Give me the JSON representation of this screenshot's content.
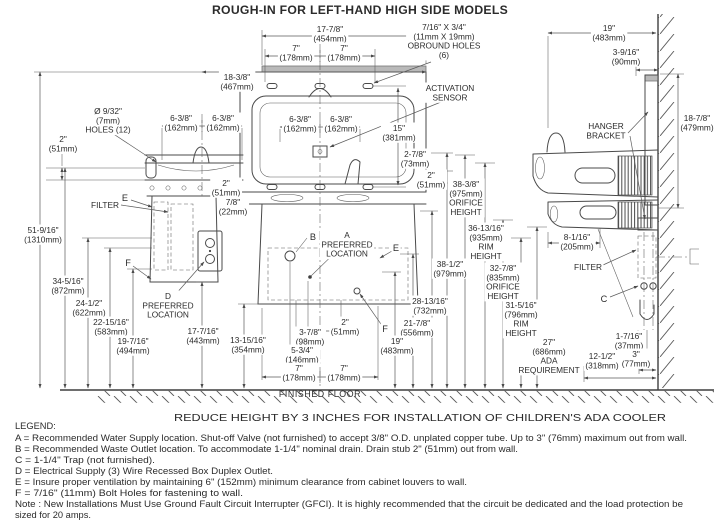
{
  "title": "ROUGH-IN FOR LEFT-HAND HIGH SIDE MODELS",
  "reduce_note": "REDUCE HEIGHT BY 3 INCHES FOR INSTALLATION OF CHILDREN'S ADA COOLER",
  "finished_floor": "FINISHED FLOOR",
  "legend": {
    "heading": "LEGEND:",
    "items": [
      "A = Recommended Water Supply location. Shut-off Valve (not furnished) to accept 3/8\" O.D. unplated copper tube. Up to 3\" (76mm) maximum out from wall.",
      "B = Recommended Waste Outlet location. To accommodate 1-1/4\" nominal drain. Drain stub 2\" (51mm) out from wall.",
      "C = 1-1/4\" Trap (not furnished).",
      "D = Electrical Supply (3) Wire Recessed Box Duplex Outlet.",
      "E = Insure proper ventilation by maintaining 6\" (152mm) minimum clearance from cabinet louvers to wall.",
      "F = 7/16\" (11mm) Bolt Holes for fastening to wall.",
      "Note : New Installations Must Use Ground Fault Circuit Interrupter (GFCI). It is highly recommended that the circuit be dedicated and the load protection be",
      "sized for 20 amps."
    ]
  },
  "dims": {
    "w454": [
      "17-7/8\"",
      "(454mm)"
    ],
    "w178l": [
      "7\"",
      "(178mm)"
    ],
    "w178r": [
      "7\"",
      "(178mm)"
    ],
    "obround": [
      "7/16\" X 3/4\"",
      "(11mm X 19mm)",
      "OBROUND HOLES",
      "(6)"
    ],
    "w467": [
      "18-3/8\"",
      "(467mm)"
    ],
    "sensor": [
      "ACTIVATION",
      "SENSOR"
    ],
    "holes12": [
      "Ø 9/32\"",
      "(7mm)",
      "HOLES (12)"
    ],
    "h51l": [
      "2\"",
      "(51mm)"
    ],
    "s638a": [
      "6-3/8\"",
      "(162mm)"
    ],
    "s638b": [
      "6-3/8\"",
      "(162mm)"
    ],
    "s638c": [
      "6-3/8\"",
      "(162mm)"
    ],
    "s638d": [
      "6-3/8\"",
      "(162mm)"
    ],
    "v381": [
      "15\"",
      "(381mm)"
    ],
    "h73": [
      "2-7/8\"",
      "(73mm)"
    ],
    "h51r": [
      "2\"",
      "(51mm)"
    ],
    "orifice1": [
      "38-3/8\"",
      "(975mm)",
      "ORIFICE",
      "HEIGHT"
    ],
    "rim1": [
      "36-13/16\"",
      "(935mm)",
      "RIM",
      "HEIGHT"
    ],
    "v979": [
      "38-1/2\"",
      "(979mm)"
    ],
    "orifice2": [
      "32-7/8\"",
      "(835mm)",
      "ORIFICE",
      "HEIGHT"
    ],
    "rim2": [
      "31-5/16\"",
      "(796mm)",
      "RIM",
      "HEIGHT"
    ],
    "ada": [
      "27\"",
      "(686mm)",
      "ADA",
      "REQUIREMENT"
    ],
    "v732": [
      "28-13/16\"",
      "(732mm)"
    ],
    "v556": [
      "21-7/8\"",
      "(556mm)"
    ],
    "v483": [
      "19\"",
      "(483mm)"
    ],
    "h51c": [
      "2\"",
      "(51mm)"
    ],
    "h98": [
      "3-7/8\"",
      "(98mm)"
    ],
    "h146": [
      "5-3/4\"",
      "(146mm)"
    ],
    "w178c": [
      "7\"",
      "(178mm)"
    ],
    "w178d": [
      "7\"",
      "(178mm)"
    ],
    "v354": [
      "13-15/16\"",
      "(354mm)"
    ],
    "v1310": [
      "51-9/16\"",
      "(1310mm)"
    ],
    "v872": [
      "34-5/16\"",
      "(872mm)"
    ],
    "v622": [
      "24-1/2\"",
      "(622mm)"
    ],
    "v583": [
      "22-15/16\"",
      "(583mm)"
    ],
    "v494": [
      "19-7/16\"",
      "(494mm)"
    ],
    "v443": [
      "17-7/16\"",
      "(443mm)"
    ],
    "h51d": [
      "2\"",
      "(51mm)"
    ],
    "h22": [
      "7/8\"",
      "(22mm)"
    ],
    "d_loc": [
      "D",
      "PREFERRED",
      "LOCATION"
    ],
    "a_loc": [
      "A",
      "PREFERRED",
      "LOCATION"
    ],
    "side19": [
      "19\"",
      "(483mm)"
    ],
    "side90": [
      "3-9/16\"",
      "(90mm)"
    ],
    "hanger": [
      "HANGER",
      "BRACKET"
    ],
    "side479": [
      "18-7/8\"",
      "(479mm)"
    ],
    "side205": [
      "8-1/16\"",
      "(205mm)"
    ],
    "side37": [
      "1-7/16\"",
      "(37mm)"
    ],
    "side318": [
      "12-1/2\"",
      "(318mm)"
    ],
    "side77": [
      "3\"",
      "(77mm)"
    ]
  },
  "callouts": {
    "filter_l": "FILTER",
    "filter_r": "FILTER",
    "a": "A",
    "b": "B",
    "c": "C",
    "e_l": "E",
    "e_r": "E",
    "f_l": "F",
    "f_r": "F"
  }
}
